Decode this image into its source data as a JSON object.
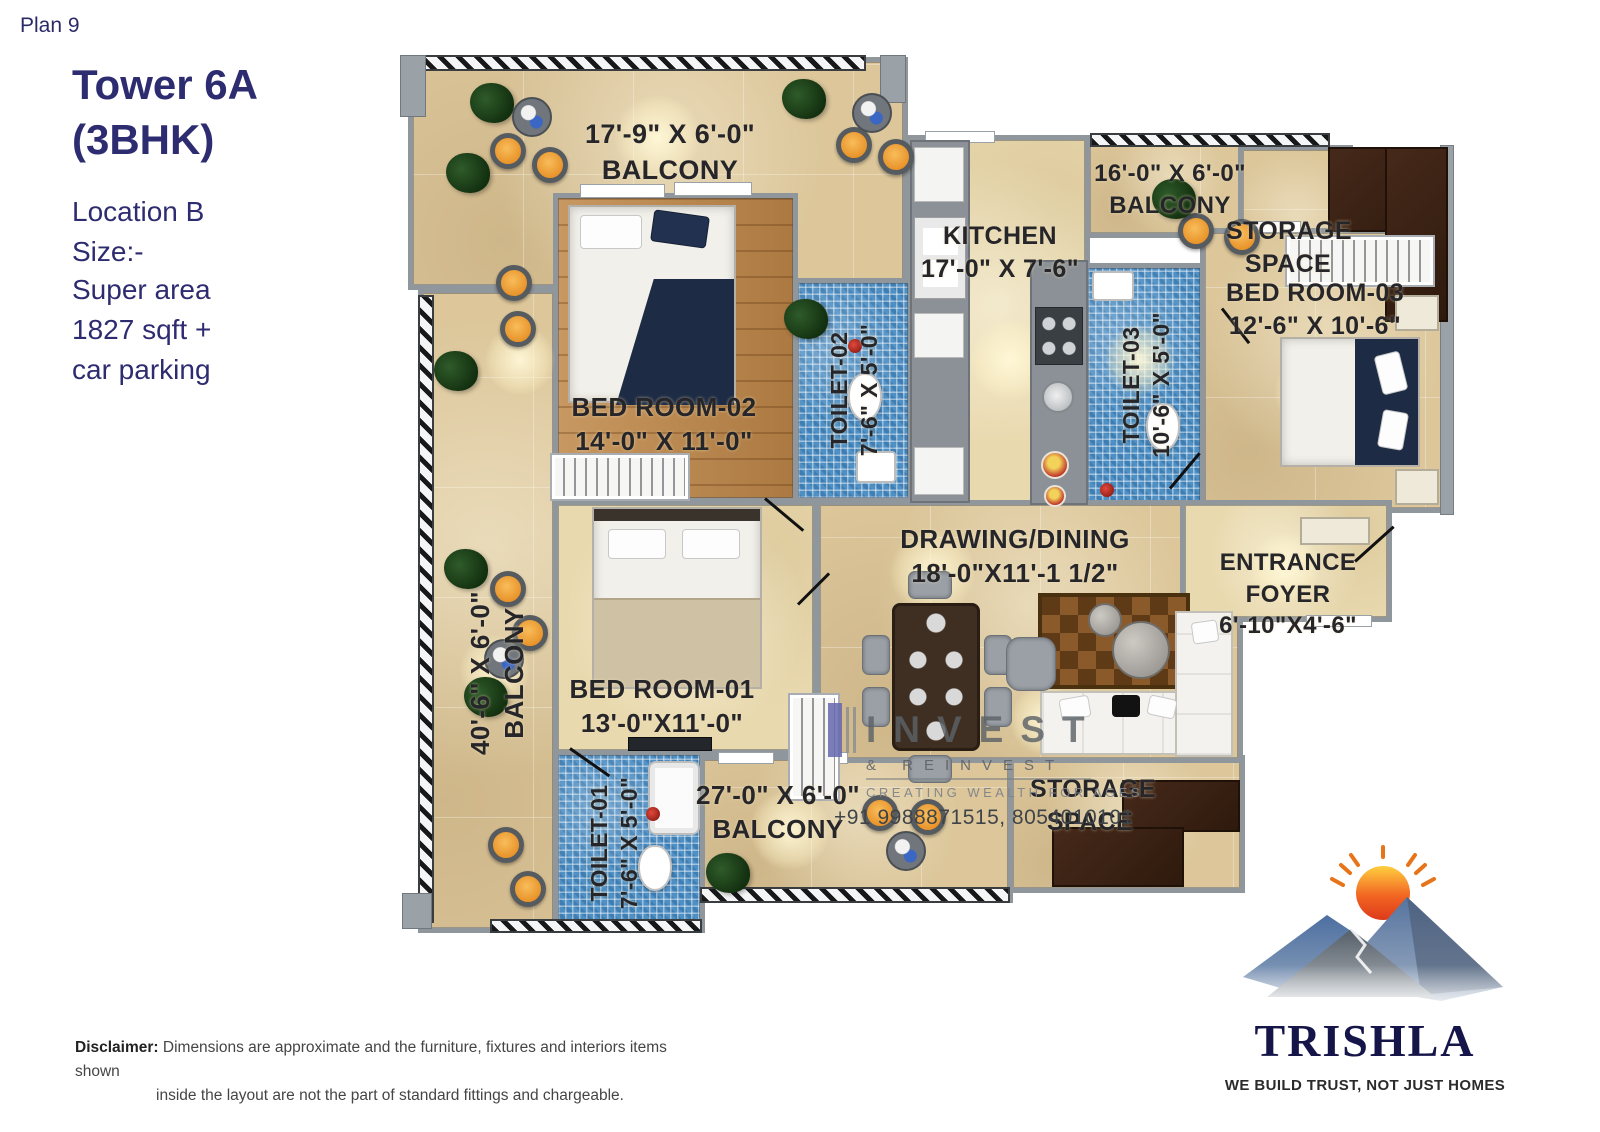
{
  "header": {
    "plan_label": "Plan 9",
    "title_line1": "Tower 6A",
    "title_line2": "(3BHK)",
    "location_line1": "Location B",
    "location_line2": "Size:-",
    "area_line1": "Super area",
    "area_line2": "1827 sqft +",
    "area_line3": "car parking"
  },
  "floor_plan": {
    "rooms": {
      "balcony_top": {
        "dims": "17'-9\" X 6'-0\"",
        "name": "BALCONY"
      },
      "kitchen": {
        "name": "KITCHEN",
        "dims": "17'-0\" X 7'-6\""
      },
      "balcony_top_right": {
        "dims": "16'-0\" X 6'-0\"",
        "name": "BALCONY"
      },
      "storage_top": {
        "name_line1": "STORAGE",
        "name_line2": "SPACE"
      },
      "bed_room_03": {
        "name": "BED ROOM-03",
        "dims": "12'-6\" X 10'-6\""
      },
      "toilet_02": {
        "name": "TOILET-02",
        "dims": "7'-6\" X 5'-0\""
      },
      "toilet_03": {
        "name": "TOILET-03",
        "dims": "10'-6\" X 5'-0\""
      },
      "bed_room_02": {
        "name": "BED ROOM-02",
        "dims": "14'-0\" X 11'-0\""
      },
      "drawing_dining": {
        "name": "DRAWING/DINING",
        "dims": "18'-0\"X11'-1 1/2\""
      },
      "entrance_foyer": {
        "name": "ENTRANCE FOYER",
        "dims": "6'-10\"X4'-6\""
      },
      "balcony_left": {
        "dims": "40'-6\" X 6'-0\"",
        "name": "BALCONY"
      },
      "bed_room_01": {
        "name": "BED ROOM-01",
        "dims": "13'-0\"X11'-0\""
      },
      "toilet_01": {
        "name": "TOILET-01",
        "dims": "7'-6\" X 5'-0\""
      },
      "balcony_bottom": {
        "dims": "27'-0\" X 6'-0\"",
        "name": "BALCONY"
      },
      "storage_bottom": {
        "name_line1": "STORAGE",
        "name_line2": "SPACE"
      }
    },
    "watermark": {
      "brand": "INVEST",
      "brand2": "& REINVEST",
      "tagline": "CREATING WEALTH FOR AGES",
      "phone": "+91 9988871515, 8054010101"
    }
  },
  "brand": {
    "name": "TRISHLA",
    "tagline": "WE BUILD TRUST, NOT JUST HOMES"
  },
  "footer": {
    "disclaimer_label": "Disclaimer:",
    "disclaimer_line1": "Dimensions are approximate and the furniture, fixtures and interiors items shown",
    "disclaimer_line2": "inside the layout are not the part of standard fittings and chargeable."
  },
  "colors": {
    "heading_navy": "#2e2c70",
    "label_ink": "#26262a",
    "wall_gray": "#8f969c",
    "floor_beige": "#dcc69a",
    "floor_wood": "#bf8748",
    "toilet_mosaic_blue": "#4e8fc4",
    "stool_orange": "#e78f25",
    "brand_navy": "#15154a",
    "sun_orange": "#f26522"
  }
}
